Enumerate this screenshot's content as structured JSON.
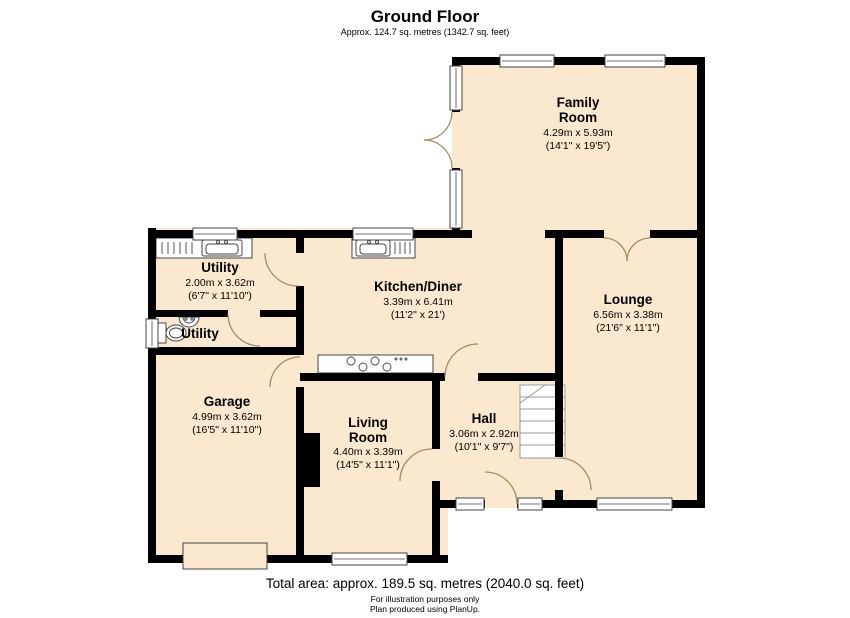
{
  "title": "Ground Floor",
  "subtitle": "Approx. 124.7 sq. metres (1342.7 sq. feet)",
  "footer": {
    "total": "Total area: approx. 189.5 sq. metres (2040.0 sq. feet)",
    "line1": "For illustration purposes only",
    "line2": "Plan produced using PlanUp."
  },
  "colors": {
    "floor": "#FAE9CE",
    "wall": "#000000",
    "door_arc": "#A88B5F",
    "window_frame": "#444444"
  },
  "rooms": {
    "family": {
      "name1": "Family",
      "name2": "Room",
      "metric": "4.29m x 5.93m",
      "imperial": "(14'1\" x 19'5\")"
    },
    "lounge": {
      "name": "Lounge",
      "metric": "6.56m x 3.38m",
      "imperial": "(21'6\" x 11'1\")"
    },
    "kitchen": {
      "name": "Kitchen/Diner",
      "metric": "3.39m x 6.41m",
      "imperial": "(11'2\" x 21')"
    },
    "utility": {
      "name": "Utility",
      "metric": "2.00m x 3.62m",
      "imperial": "(6'7\" x 11'10\")"
    },
    "wc": {
      "name": "Utility"
    },
    "garage": {
      "name": "Garage",
      "metric": "4.99m x 3.62m",
      "imperial": "(16'5\" x 11'10\")"
    },
    "living": {
      "name1": "Living",
      "name2": "Room",
      "metric": "4.40m x 3.39m",
      "imperial": "(14'5\" x 11'1\")"
    },
    "hall": {
      "name": "Hall",
      "metric": "3.06m x 2.92m",
      "imperial": "(10'1\" x 9'7\")"
    }
  }
}
